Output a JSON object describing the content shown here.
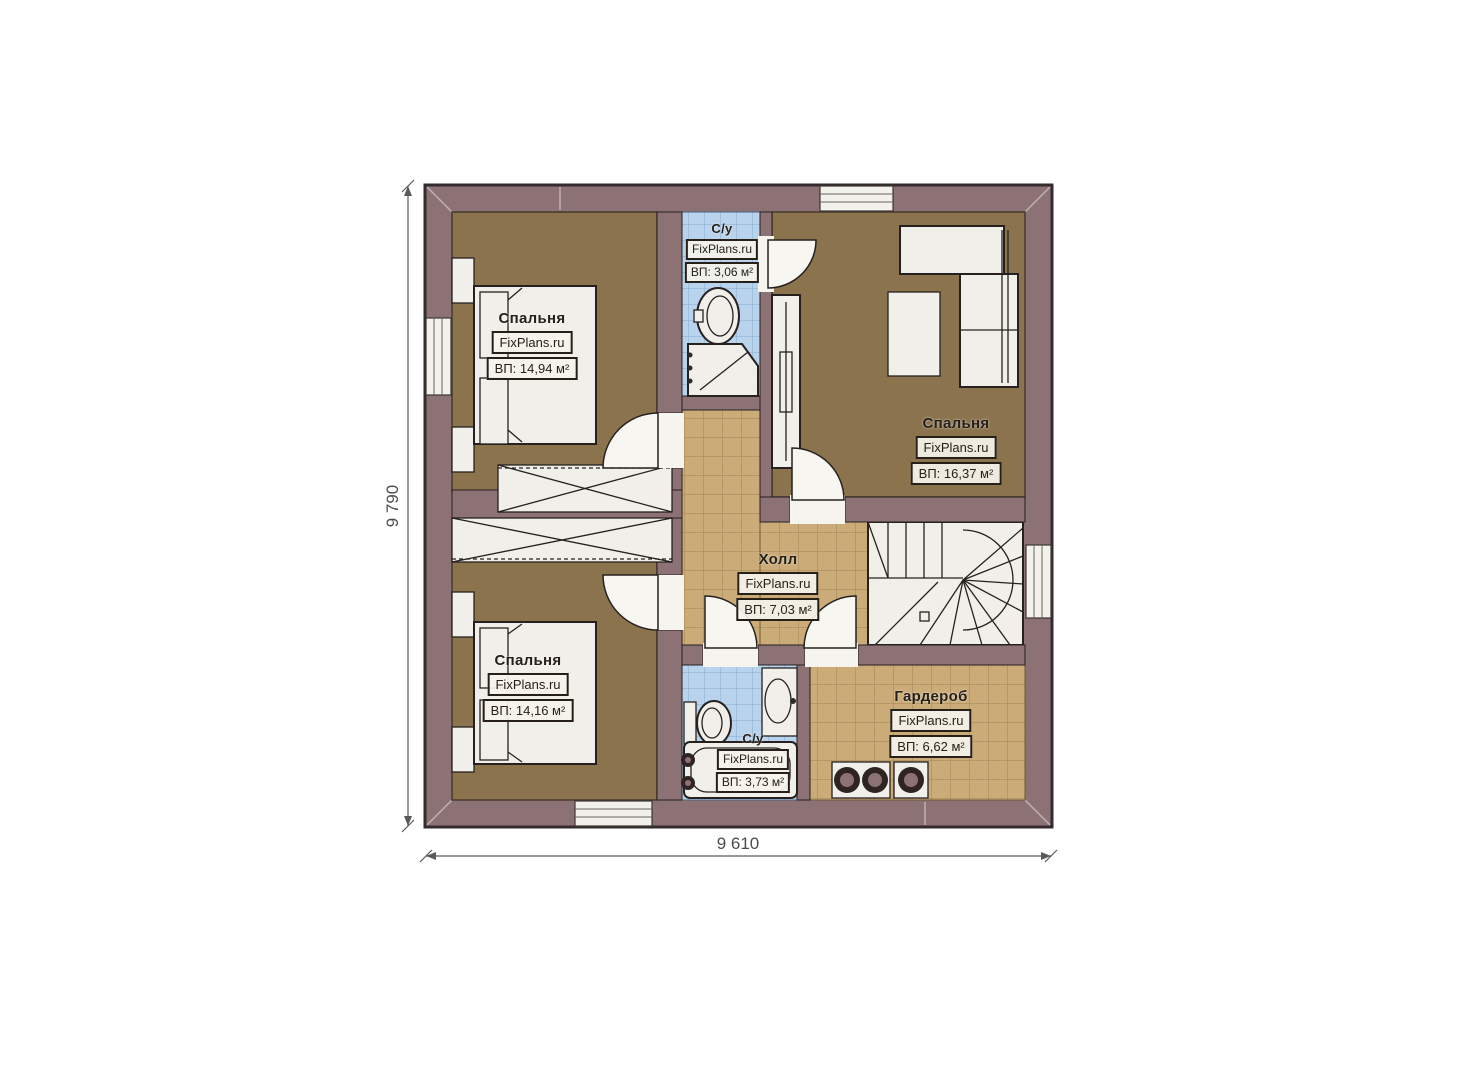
{
  "colors": {
    "background": "#ffffff",
    "wall": "#8c7175",
    "wall_outline": "#332b2d",
    "line": "#26211e",
    "bedroom_floor": "#8b734e",
    "tile_floor": "#cbab78",
    "tile_grid": "#a28655",
    "bath_floor": "#b9d3ed",
    "bath_grid": "#84abd0",
    "furniture": "#f0efea",
    "dim_line": "#5a5a5a"
  },
  "rooms": {
    "bedroom_tl": {
      "name": "Спальня",
      "brand": "FixPlans.ru",
      "area": "ВП: 14,94 м²"
    },
    "bath_top": {
      "name": "С/у",
      "brand": "FixPlans.ru",
      "area": "ВП: 3,06 м²"
    },
    "bedroom_tr": {
      "name": "Спальня",
      "brand": "FixPlans.ru",
      "area": "ВП: 16,37 м²"
    },
    "hall": {
      "name": "Холл",
      "brand": "FixPlans.ru",
      "area": "ВП: 7,03 м²"
    },
    "bedroom_bl": {
      "name": "Спальня",
      "brand": "FixPlans.ru",
      "area": "ВП: 14,16 м²"
    },
    "bath_bottom": {
      "name": "С/у",
      "brand": "FixPlans.ru",
      "area": "ВП: 3,73 м²"
    },
    "wardrobe": {
      "name": "Гардероб",
      "brand": "FixPlans.ru",
      "area": "ВП: 6,62 м²"
    }
  },
  "dimensions": {
    "left": "9 790",
    "bottom": "9 610"
  }
}
